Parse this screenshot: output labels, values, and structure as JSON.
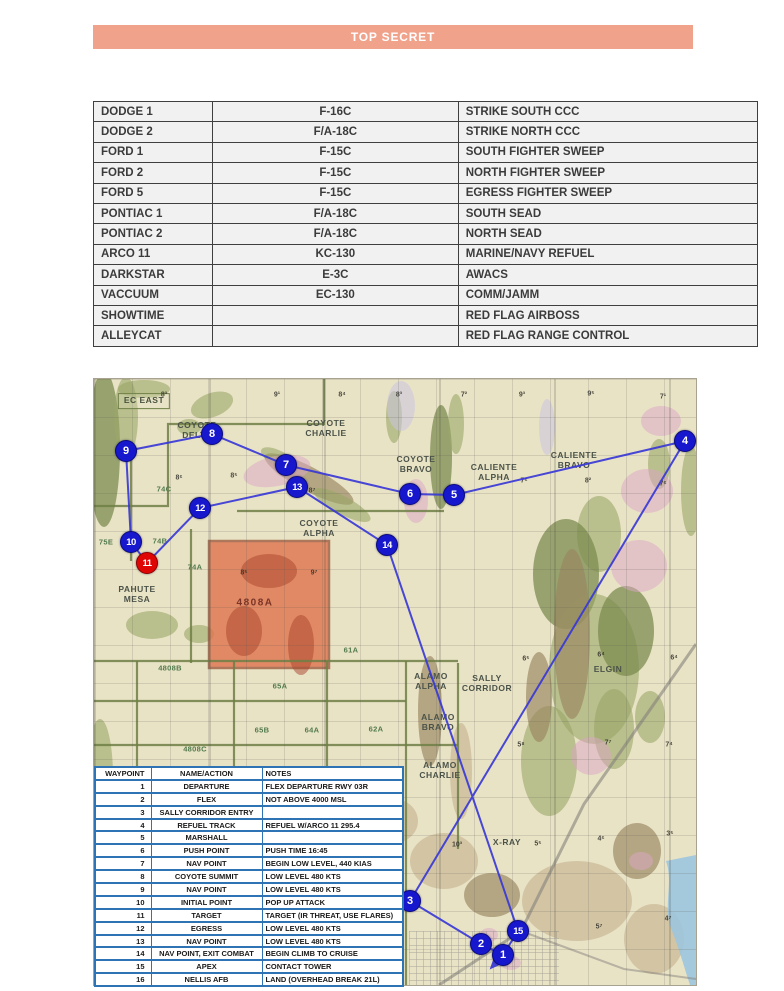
{
  "banner": {
    "text": "TOP SECRET",
    "bg_color": "#F0A28B"
  },
  "colors": {
    "banner_bg": "#F0A28B",
    "roster_cell_bg": "#F1F1F1",
    "roster_border": "#3F3F3F",
    "waypoint_table_border": "#2E74B5",
    "route_line": "#3838D6",
    "waypoint_marker": "#1717CD",
    "target_marker": "#E00505",
    "map_base": "#E9E3C6",
    "target_area_fill": "#E0714B"
  },
  "roster_table": {
    "rows": [
      [
        "DODGE 1",
        "F-16C",
        "STRIKE SOUTH CCC"
      ],
      [
        "DODGE 2",
        "F/A-18C",
        "STRIKE NORTH CCC"
      ],
      [
        "FORD 1",
        "F-15C",
        "SOUTH FIGHTER SWEEP"
      ],
      [
        "FORD 2",
        "F-15C",
        "NORTH FIGHTER SWEEP"
      ],
      [
        "FORD 5",
        "F-15C",
        "EGRESS FIGHTER SWEEP"
      ],
      [
        "PONTIAC 1",
        "F/A-18C",
        "SOUTH SEAD"
      ],
      [
        "PONTIAC 2",
        "F/A-18C",
        "NORTH SEAD"
      ],
      [
        "ARCO 11",
        "KC-130",
        "MARINE/NAVY REFUEL"
      ],
      [
        "DARKSTAR",
        "E-3C",
        "AWACS"
      ],
      [
        "VACCUUM",
        "EC-130",
        "COMM/JAMM"
      ],
      [
        "SHOWTIME",
        "",
        "RED FLAG AIRBOSS"
      ],
      [
        "ALLEYCAT",
        "",
        "RED FLAG RANGE CONTROL"
      ]
    ]
  },
  "map": {
    "area_labels": [
      {
        "text": "EC EAST",
        "x": 50,
        "y": 22,
        "boxed": true
      },
      {
        "text": "COYOTE\nDELTA",
        "x": 103,
        "y": 52
      },
      {
        "text": "COYOTE\nCHARLIE",
        "x": 232,
        "y": 50
      },
      {
        "text": "COYOTE\nBRAVO",
        "x": 322,
        "y": 86
      },
      {
        "text": "CALIENTE\nALPHA",
        "x": 400,
        "y": 94
      },
      {
        "text": "CALIENTE\nBRAVO",
        "x": 480,
        "y": 82
      },
      {
        "text": "COYOTE\nALPHA",
        "x": 225,
        "y": 150
      },
      {
        "text": "PAHUTE\nMESA",
        "x": 43,
        "y": 216
      },
      {
        "text": "ALAMO\nALPHA",
        "x": 337,
        "y": 303
      },
      {
        "text": "SALLY\nCORRIDOR",
        "x": 393,
        "y": 305
      },
      {
        "text": "ELGIN",
        "x": 514,
        "y": 291
      },
      {
        "text": "ALAMO\nBRAVO",
        "x": 344,
        "y": 344
      },
      {
        "text": "ALAMO\nCHARLIE",
        "x": 346,
        "y": 392
      },
      {
        "text": "X-RAY",
        "x": 413,
        "y": 464
      }
    ],
    "range_codes": [
      {
        "text": "74C",
        "x": 70,
        "y": 110
      },
      {
        "text": "75E",
        "x": 12,
        "y": 163
      },
      {
        "text": "74B",
        "x": 66,
        "y": 162
      },
      {
        "text": "74A",
        "x": 101,
        "y": 188
      },
      {
        "text": "4808B",
        "x": 76,
        "y": 289
      },
      {
        "text": "4808C",
        "x": 101,
        "y": 370
      },
      {
        "text": "61A",
        "x": 257,
        "y": 271
      },
      {
        "text": "65A",
        "x": 186,
        "y": 307
      },
      {
        "text": "65B",
        "x": 168,
        "y": 351
      },
      {
        "text": "64A",
        "x": 218,
        "y": 351
      },
      {
        "text": "62A",
        "x": 282,
        "y": 350
      }
    ],
    "target_area_label": {
      "text": "4808A",
      "x": 161,
      "y": 224
    },
    "elevation_marks": [
      {
        "text": "8³",
        "x": 70,
        "y": 16
      },
      {
        "text": "9¹",
        "x": 183,
        "y": 16
      },
      {
        "text": "8⁴",
        "x": 248,
        "y": 16
      },
      {
        "text": "8³",
        "x": 305,
        "y": 16
      },
      {
        "text": "7²",
        "x": 370,
        "y": 16
      },
      {
        "text": "9³",
        "x": 428,
        "y": 16
      },
      {
        "text": "9⁵",
        "x": 497,
        "y": 15
      },
      {
        "text": "7¹",
        "x": 569,
        "y": 18
      },
      {
        "text": "8⁶",
        "x": 85,
        "y": 99
      },
      {
        "text": "8⁵",
        "x": 140,
        "y": 97
      },
      {
        "text": "8⁷",
        "x": 218,
        "y": 112
      },
      {
        "text": "8⁵",
        "x": 150,
        "y": 194
      },
      {
        "text": "9⁷",
        "x": 220,
        "y": 194
      },
      {
        "text": "7⁶",
        "x": 430,
        "y": 102
      },
      {
        "text": "8²",
        "x": 494,
        "y": 102
      },
      {
        "text": "7⁶",
        "x": 569,
        "y": 105
      },
      {
        "text": "6⁵",
        "x": 432,
        "y": 280
      },
      {
        "text": "6⁴",
        "x": 507,
        "y": 276
      },
      {
        "text": "6⁴",
        "x": 580,
        "y": 279
      },
      {
        "text": "5⁸",
        "x": 427,
        "y": 366
      },
      {
        "text": "7⁷",
        "x": 514,
        "y": 364
      },
      {
        "text": "7⁴",
        "x": 575,
        "y": 366
      },
      {
        "text": "10³",
        "x": 363,
        "y": 466
      },
      {
        "text": "5⁵",
        "x": 444,
        "y": 465
      },
      {
        "text": "4⁶",
        "x": 507,
        "y": 460
      },
      {
        "text": "3⁵",
        "x": 576,
        "y": 455
      },
      {
        "text": "5⁷",
        "x": 505,
        "y": 548
      },
      {
        "text": "4⁷",
        "x": 574,
        "y": 540
      }
    ],
    "waypoints": [
      {
        "num": "1",
        "x": 409,
        "y": 576,
        "color": "blue"
      },
      {
        "num": "2",
        "x": 387,
        "y": 565,
        "color": "blue"
      },
      {
        "num": "3",
        "x": 316,
        "y": 522,
        "color": "blue"
      },
      {
        "num": "4",
        "x": 591,
        "y": 62,
        "color": "blue"
      },
      {
        "num": "5",
        "x": 360,
        "y": 116,
        "color": "blue"
      },
      {
        "num": "6",
        "x": 316,
        "y": 115,
        "color": "blue"
      },
      {
        "num": "7",
        "x": 192,
        "y": 86,
        "color": "blue"
      },
      {
        "num": "8",
        "x": 118,
        "y": 55,
        "color": "blue"
      },
      {
        "num": "9",
        "x": 32,
        "y": 72,
        "color": "blue"
      },
      {
        "num": "10",
        "x": 37,
        "y": 163,
        "color": "blue"
      },
      {
        "num": "11",
        "x": 53,
        "y": 184,
        "color": "red"
      },
      {
        "num": "12",
        "x": 106,
        "y": 129,
        "color": "blue"
      },
      {
        "num": "13",
        "x": 203,
        "y": 108,
        "color": "blue"
      },
      {
        "num": "14",
        "x": 293,
        "y": 166,
        "color": "blue"
      },
      {
        "num": "15",
        "x": 424,
        "y": 552,
        "color": "blue"
      }
    ],
    "route_points": [
      [
        409,
        576
      ],
      [
        387,
        565
      ],
      [
        316,
        522
      ],
      [
        591,
        62
      ],
      [
        360,
        116
      ],
      [
        316,
        115
      ],
      [
        192,
        86
      ],
      [
        118,
        55
      ],
      [
        32,
        72
      ],
      [
        37,
        163
      ],
      [
        53,
        184
      ],
      [
        106,
        129
      ],
      [
        203,
        108
      ],
      [
        293,
        166
      ],
      [
        424,
        552
      ]
    ],
    "arrow_leg": [
      [
        424,
        552
      ],
      [
        409,
        576
      ],
      [
        397,
        589
      ]
    ]
  },
  "waypoint_table": {
    "headers": [
      "WAYPOINT",
      "NAME/ACTION",
      "NOTES"
    ],
    "rows": [
      [
        "1",
        "DEPARTURE",
        "FLEX DEPARTURE RWY 03R"
      ],
      [
        "2",
        "FLEX",
        "NOT ABOVE 4000 MSL"
      ],
      [
        "3",
        "SALLY CORRIDOR ENTRY",
        ""
      ],
      [
        "4",
        "REFUEL TRACK",
        "REFUEL W/ARCO 11 295.4"
      ],
      [
        "5",
        "MARSHALL",
        ""
      ],
      [
        "6",
        "PUSH POINT",
        "PUSH TIME 16:45"
      ],
      [
        "7",
        "NAV POINT",
        "BEGIN LOW LEVEL, 440 KIAS"
      ],
      [
        "8",
        "COYOTE SUMMIT",
        "LOW LEVEL 480 KTS"
      ],
      [
        "9",
        "NAV POINT",
        "LOW LEVEL 480 KTS"
      ],
      [
        "10",
        "INITIAL POINT",
        "POP UP ATTACK"
      ],
      [
        "11",
        "TARGET",
        "TARGET (IR THREAT, USE FLARES)"
      ],
      [
        "12",
        "EGRESS",
        "LOW LEVEL 480 KTS"
      ],
      [
        "13",
        "NAV POINT",
        "LOW LEVEL 480 KTS"
      ],
      [
        "14",
        "NAV POINT, EXIT COMBAT",
        "BEGIN CLIMB TO CRUISE"
      ],
      [
        "15",
        "APEX",
        "CONTACT TOWER"
      ],
      [
        "16",
        "NELLIS AFB",
        "LAND (OVERHEAD BREAK 21L)"
      ]
    ]
  }
}
